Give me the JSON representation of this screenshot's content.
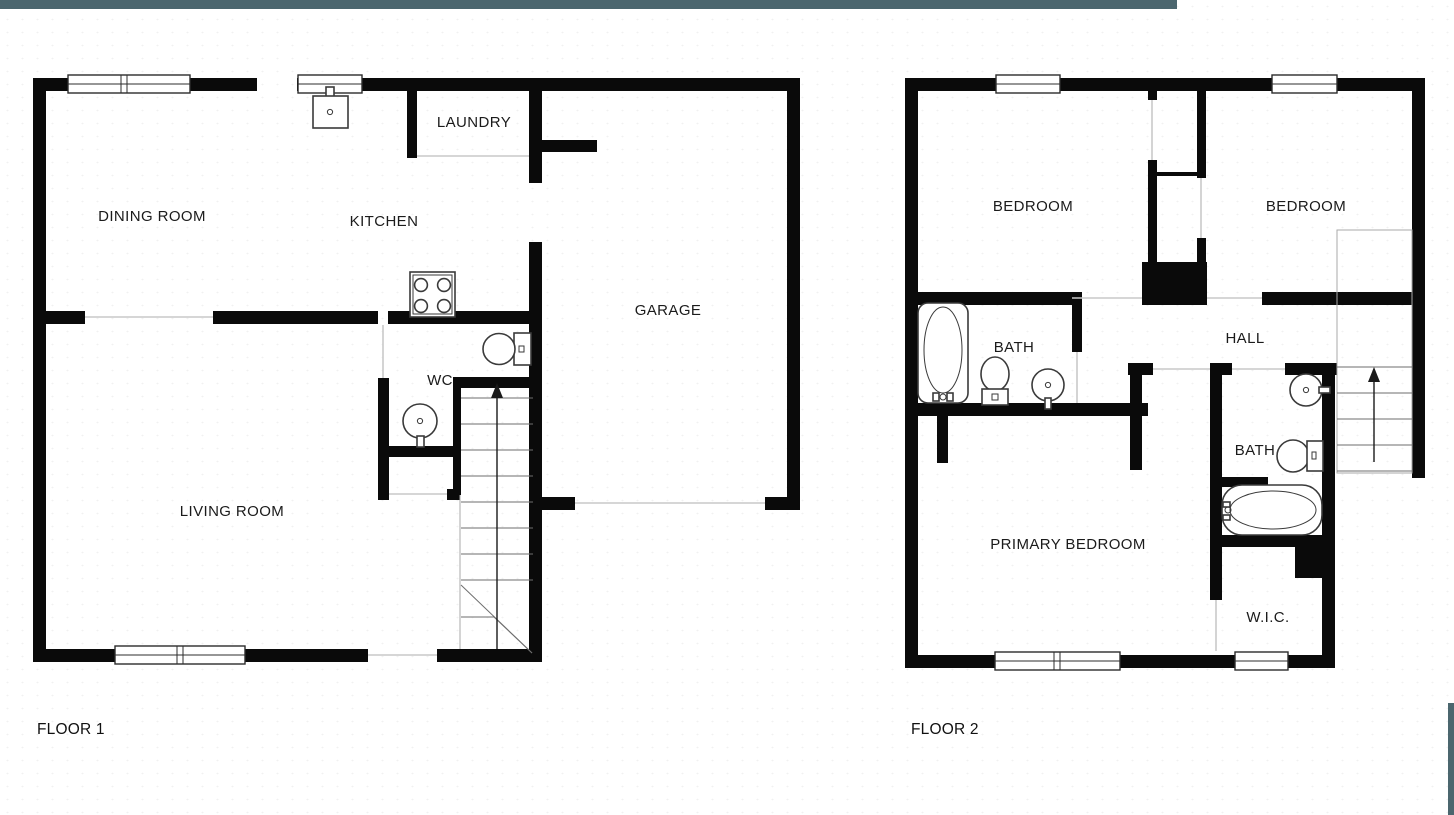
{
  "theme": {
    "wall_color": "#0a0a0a",
    "accent_bar_color": "#4b666e",
    "background_color": "#ffffff",
    "door_line_color": "#c9c9c9"
  },
  "floor1": {
    "label": "FLOOR 1",
    "rooms": {
      "dining": "DINING ROOM",
      "kitchen": "KITCHEN",
      "laundry": "LAUNDRY",
      "garage": "GARAGE",
      "wc": "WC",
      "living": "LIVING ROOM"
    },
    "fixtures": [
      "kitchen-sink-icon",
      "stove-icon",
      "toilet-icon",
      "round-sink-icon",
      "stairs-up-arrow-icon"
    ]
  },
  "floor2": {
    "label": "FLOOR 2",
    "rooms": {
      "bedroom_left": "BEDROOM",
      "bedroom_right": "BEDROOM",
      "bath_upper": "BATH",
      "hall": "HALL",
      "bath_lower": "BATH",
      "primary": "PRIMARY BEDROOM",
      "wic": "W.I.C."
    },
    "fixtures": [
      "bathtub-icon",
      "toilet-icon",
      "round-sink-icon",
      "round-sink-icon",
      "toilet-icon",
      "bathtub-icon",
      "stairs-up-arrow-icon"
    ]
  }
}
